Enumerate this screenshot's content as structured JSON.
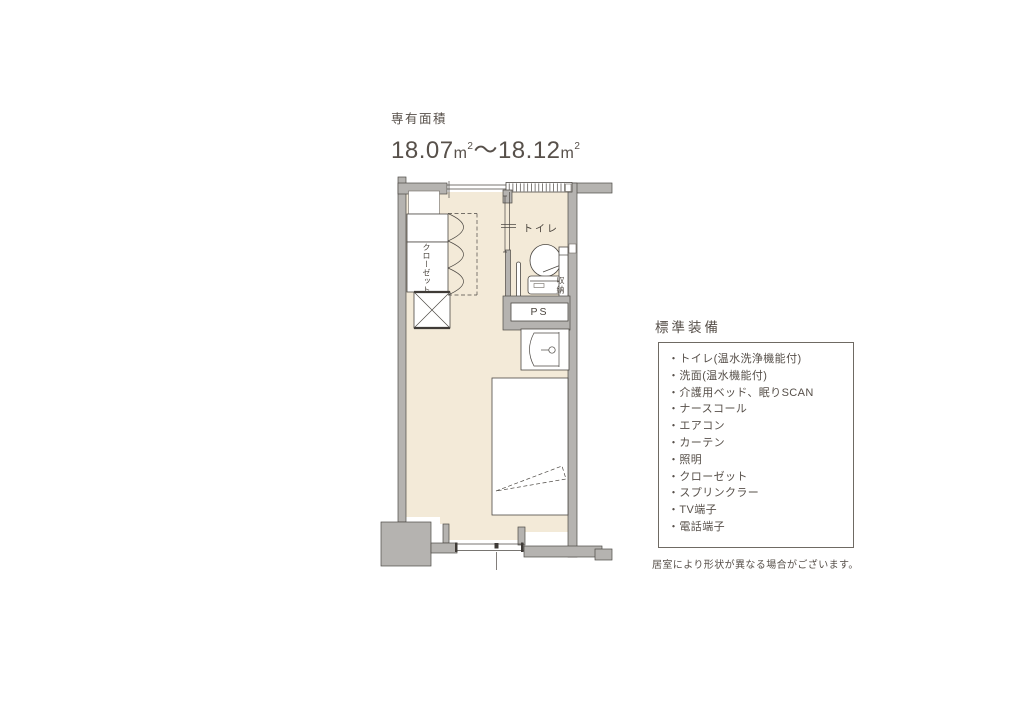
{
  "title": {
    "label": "専有面積",
    "value_from": "18.07",
    "value_to": "18.12",
    "unit": "m",
    "sup": "2",
    "separator": "〜"
  },
  "floorplan": {
    "labels": {
      "toilet": "トイレ",
      "closet": "クローゼット",
      "storage": "収納",
      "pipe_space": "PS"
    }
  },
  "equipment": {
    "heading": "標準装備",
    "bullet": "・",
    "items": [
      "トイレ(温水洗浄機能付)",
      "洗面(温水機能付)",
      "介護用ベッド、眠りSCAN",
      "ナースコール",
      "エアコン",
      "カーテン",
      "照明",
      "クローゼット",
      "スプリンクラー",
      "TV端子",
      "電話端子"
    ],
    "note": "居室により形状が異なる場合がございます。"
  },
  "colors": {
    "floor": "#f3ead8",
    "wall": "#b5b3b0",
    "line": "#4c4843",
    "text": "#57504a",
    "background": "#ffffff"
  }
}
